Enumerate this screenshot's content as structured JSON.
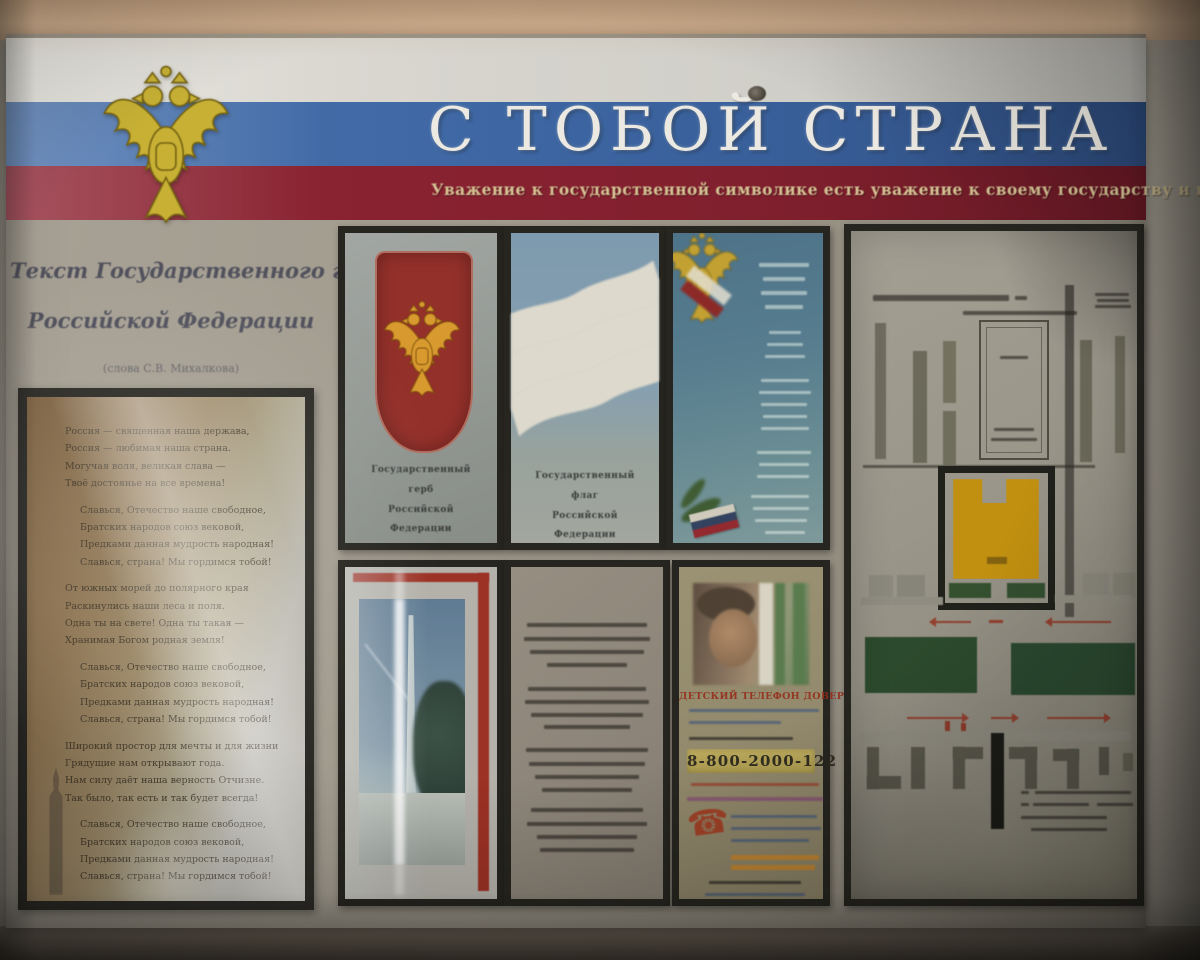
{
  "palette": {
    "wall": "#c7a98b",
    "board_bg": "#a19b8e",
    "flag_white": "#d6d4cd",
    "flag_blue": "#3d66a2",
    "flag_red": "#862130",
    "title_color": "#ebe9e1",
    "subtitle_gold": "#d6c394",
    "eagle_gold": "#c7b034",
    "shield_red": "#94302a",
    "helpline_red": "#942c18",
    "scheme_green": "#2c4a2d",
    "scheme_yellow": "#c19010",
    "arrow_red": "#93402f"
  },
  "header": {
    "title": "С ТОБОЙ СТРАНА",
    "subtitle": "Уважение к государственной символике есть уважение к своему государству и к своей стране",
    "emblem": "russian-double-headed-eagle"
  },
  "anthem_panel": {
    "heading_line1": "Текст Государственного гимна",
    "heading_line2": "Российской Федерации",
    "author_note": "(слова С.В. Михалкова)",
    "blocks": [
      {
        "indent": false,
        "lines": [
          "Россия — священная наша держава,",
          "Россия — любимая наша страна.",
          "Могучая воля, великая слава —",
          "Твоё достоянье на все времена!"
        ]
      },
      {
        "indent": true,
        "lines": [
          "Славься, Отечество наше свободное,",
          "Братских народов союз вековой,",
          "Предками данная мудрость народная!",
          "Славься, страна! Мы гордимся тобой!"
        ]
      },
      {
        "indent": false,
        "lines": [
          "От южных морей до полярного края",
          "Раскинулись наши леса и поля.",
          "Одна ты на свете! Одна ты такая —",
          "Хранимая Богом родная земля!"
        ]
      },
      {
        "indent": true,
        "lines": [
          "Славься, Отечество наше свободное,",
          "Братских народов союз вековой,",
          "Предками данная мудрость народная!",
          "Славься, страна! Мы гордимся тобой!"
        ]
      },
      {
        "indent": false,
        "lines": [
          "Широкий простор для мечты и для жизни",
          "Грядущие нам открывают года.",
          "Нам силу даёт наша верность Отчизне.",
          "Так было, так есть и так будет всегда!"
        ]
      },
      {
        "indent": true,
        "lines": [
          "Славься, Отечество наше свободное,",
          "Братских народов союз вековой,",
          "Предками данная мудрость народная!",
          "Славься, страна! Мы гордимся тобой!"
        ]
      }
    ]
  },
  "posters": {
    "coat_of_arms": {
      "image": "red-shield-with-golden-double-headed-eagle",
      "caption_lines": [
        "Государственный",
        "герб",
        "Российской",
        "Федерации"
      ]
    },
    "flag": {
      "image": "waving-white-blue-red-tricolor",
      "caption_lines": [
        "Государственный",
        "флаг",
        "Российской",
        "Федерации"
      ]
    },
    "anthem_poster": {
      "image": "blue-poster-with-gold-eagle-flag-and-verse-text",
      "text_legible": false
    },
    "monument_photo": {
      "image": "photo-of-white-obelisk-memorial-with-tree",
      "text_legible": false
    },
    "poem": {
      "stanzas": 4,
      "lines_per_stanza": 4,
      "text_legible": false
    },
    "helpline": {
      "image": "photo-of-child-talking-on-phone",
      "heading": "ДЕТСКИЙ ТЕЛЕФОН ДОВЕРИЯ",
      "phone": "8-800-2000-122",
      "other_text_legible": false
    }
  },
  "scheme_panel": {
    "image": "territory-plan-diagram-with-buildings-lawns-and-route-arrows",
    "text_legible": false,
    "features": [
      "yellow-building-in-black-frame",
      "green-lawn-rectangles",
      "red-direction-arrows",
      "gray-building-blocks",
      "legend-text-bottom-right"
    ]
  }
}
